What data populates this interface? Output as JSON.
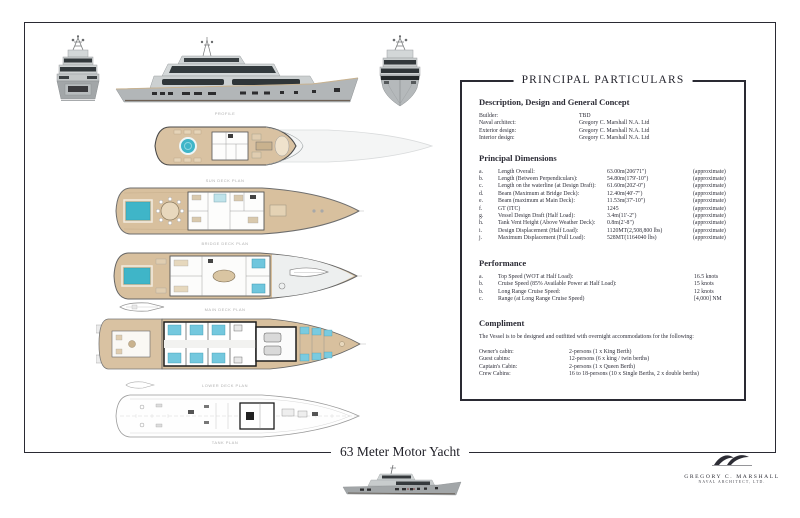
{
  "document": {
    "footer_title": "63 Meter Motor Yacht"
  },
  "logo": {
    "name": "GREGORY C. MARSHALL",
    "subtitle": "NAVAL ARCHITECT, LTD."
  },
  "captions": {
    "profile": "PROFILE",
    "sun_deck": "SUN DECK PLAN",
    "bridge_deck": "BRIDGE DECK PLAN",
    "main_deck": "MAIN DECK PLAN",
    "lower_deck": "LOWER DECK PLAN",
    "tank_deck": "TANK PLAN"
  },
  "colors": {
    "ink": "#2a2a33",
    "deck_tan": "#d8c09e",
    "pool_blue": "#3fb5c8",
    "bed_blue": "#74c8de",
    "hull_gray": "#b2b6b8"
  },
  "particulars": {
    "title": "PRINCIPAL PARTICULARS",
    "concept": {
      "heading": "Description, Design and General Concept",
      "rows": [
        {
          "label": "Builder:",
          "value": "TBD"
        },
        {
          "label": "Naval architect:",
          "value": "Gregory C. Marshall N.A. Ltd"
        },
        {
          "label": "Exterior design:",
          "value": "Gregory C. Marshall N.A. Ltd"
        },
        {
          "label": "Interior design:",
          "value": "Gregory C. Marshall N.A. Ltd"
        }
      ]
    },
    "dimensions": {
      "heading": "Principal Dimensions",
      "rows": [
        {
          "index": "a.",
          "label": "Length Overall:",
          "value": "63.00m(206'71\")",
          "note": "(approximate)"
        },
        {
          "index": "b.",
          "label": "Length (Between Perpendiculars):",
          "value": "54.80m(179'-10\")",
          "note": "(approximate)"
        },
        {
          "index": "c.",
          "label": "Length on the waterline (at Design Draft):",
          "value": "61.60m(202'-0\")",
          "note": "(approximate)"
        },
        {
          "index": "d.",
          "label": "Beam (Maximum at Bridge Deck):",
          "value": "12.40m(40'-7\")",
          "note": "(approximate)"
        },
        {
          "index": "e.",
          "label": "Beam (maximum at Main Deck):",
          "value": "11.53m(37'-10\")",
          "note": "(approximate)"
        },
        {
          "index": "f.",
          "label": "GT (ITC)",
          "value": "1245",
          "note": "(approximate)"
        },
        {
          "index": "g.",
          "label": "Vessel Design Draft (Half Load):",
          "value": "3.4m(11'-2\")",
          "note": "(approximate)"
        },
        {
          "index": "h.",
          "label": "Tank Vent Height (Above Weather Deck):",
          "value": "0.8m(2'-8\")",
          "note": "(approximate)"
        },
        {
          "index": "i.",
          "label": "Design Displacement (Half Load):",
          "value": "1120MT(2,508,800 lbs)",
          "note": "(approximate)"
        },
        {
          "index": "j.",
          "label": "Maximum Displacement (Full Load):",
          "value": "528MT(1164040 lbs)",
          "note": "(approximate)"
        }
      ]
    },
    "performance": {
      "heading": "Performance",
      "rows": [
        {
          "index": "a.",
          "label": "Top Speed (WOT at Half Load):",
          "value": "16.5 knots"
        },
        {
          "index": "b.",
          "label": "Cruise Speed (85% Available Power at Half Load):",
          "value": "15 knots"
        },
        {
          "index": "b.",
          "label": "Long Range Cruise Speed:",
          "value": "12 knots"
        },
        {
          "index": "c.",
          "label": "Range (at Long Range Cruise Speed)",
          "value": "[4,000] NM"
        }
      ]
    },
    "compliment": {
      "heading": "Compliment",
      "intro": "The Vessel is to be designed and outfitted with overnight accommodations for the following:",
      "rows": [
        {
          "label": "Owner's cabin:",
          "value": "2-persons (1 x King Berth)"
        },
        {
          "label": "Guest cabins:",
          "value": "12-persons (6 x  king / twin berths)"
        },
        {
          "label": "Captain's Cabin:",
          "value": "2-persons (1 x Queen Berth)"
        },
        {
          "label": "Crew Cabins:",
          "value": "16 to 18-persons (10 x Single Berths, 2 x double berths)"
        }
      ]
    }
  }
}
